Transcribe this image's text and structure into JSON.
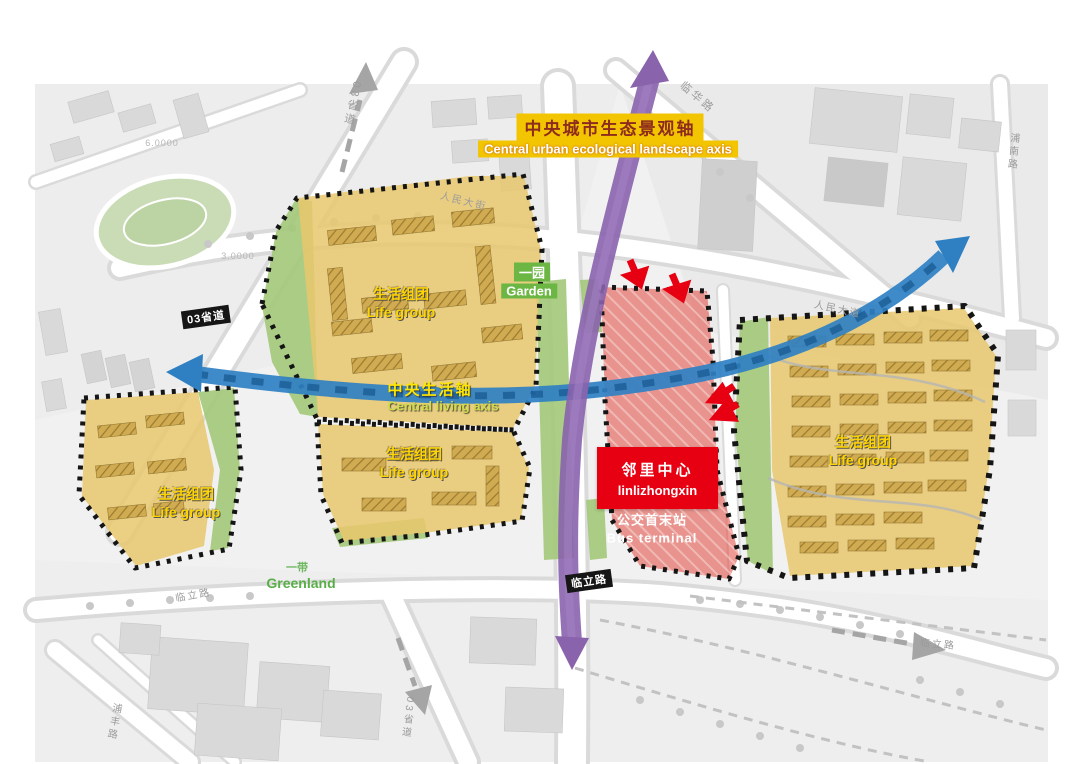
{
  "diagram": {
    "eco_axis": {
      "zh": "中央城市生态景观轴",
      "en": "Central urban ecological landscape axis"
    },
    "living_axis": {
      "zh": "中央生活轴",
      "en": "Central living axis"
    },
    "garden": {
      "zh": "一园",
      "en": "Garden"
    },
    "greenland": {
      "zh": "一带",
      "en": "Greenland"
    },
    "life_group": {
      "zh": "生活组团",
      "en": "Life group"
    },
    "neighborhood_center": {
      "zh": "邻里中心",
      "en": "linlizhongxin"
    },
    "bus_terminal": {
      "zh": "公交首末站",
      "en": "Bus terminal"
    }
  },
  "roads": {
    "s03_badge": "03省道",
    "linli_badge": "临立路",
    "linhua": "临华路",
    "s03_top": "03省道",
    "s03_bottom": "03省道",
    "renmin_left": "人民大街",
    "renmin_right": "人民大道",
    "linli_left": "临立路",
    "linli_right": "临立路",
    "punan": "浦南路",
    "pufeng": "浦丰路",
    "elev_6": "6.0000",
    "elev_3": "3.0000"
  },
  "colors": {
    "eco_axis": "#8a63ad",
    "living_axis": "#2f80c3",
    "life_group_fill": "#e8c76c",
    "green_fill": "#a3c878",
    "red_zone_fill": "#e0463a",
    "red_solid": "#e60012",
    "label_yellow_bg": "#f2c500",
    "life_label_yellow": "#ffd400",
    "green_label": "#58ae47",
    "badge_bg": "#161616"
  }
}
